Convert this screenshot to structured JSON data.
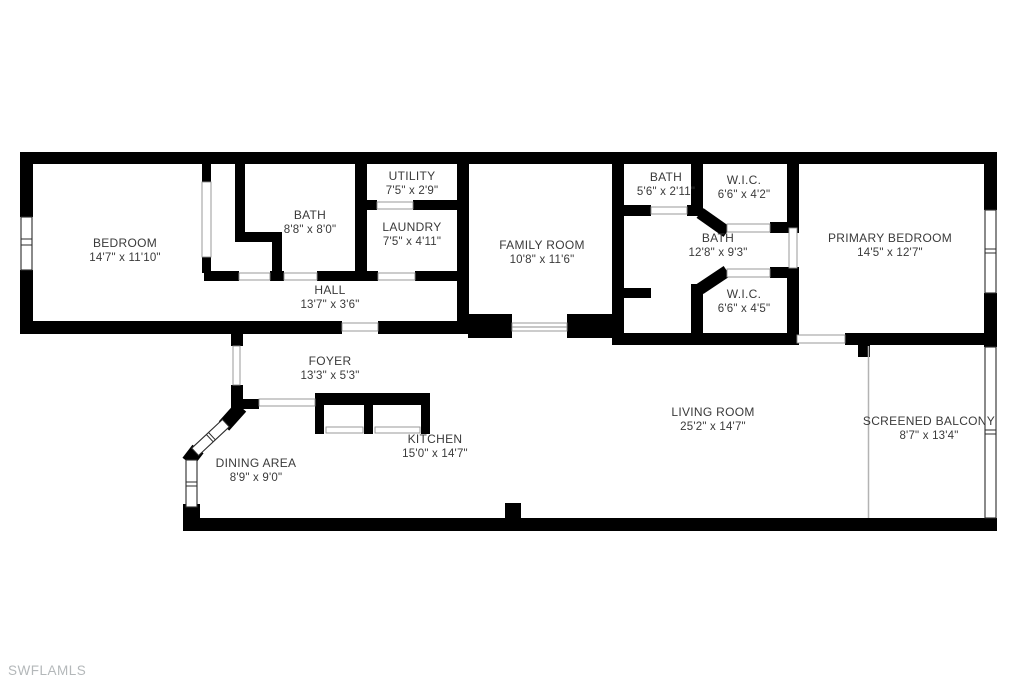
{
  "watermark": "SWFLAMLS",
  "rooms": [
    {
      "name": "BEDROOM",
      "dims": "14'7\" x 11'10\""
    },
    {
      "name": "BATH",
      "dims": "8'8\" x 8'0\""
    },
    {
      "name": "UTILITY",
      "dims": "7'5\" x 2'9\""
    },
    {
      "name": "LAUNDRY",
      "dims": "7'5\" x 4'11\""
    },
    {
      "name": "FAMILY ROOM",
      "dims": "10'8\" x 11'6\""
    },
    {
      "name": "BATH",
      "dims": "5'6\" x 2'11\""
    },
    {
      "name": "W.I.C.",
      "dims": "6'6\" x 4'2\""
    },
    {
      "name": "BATH",
      "dims": "12'8\" x 9'3\""
    },
    {
      "name": "PRIMARY BEDROOM",
      "dims": "14'5\" x 12'7\""
    },
    {
      "name": "W.I.C.",
      "dims": "6'6\" x 4'5\""
    },
    {
      "name": "HALL",
      "dims": "13'7\" x 3'6\""
    },
    {
      "name": "FOYER",
      "dims": "13'3\" x 5'3\""
    },
    {
      "name": "KITCHEN",
      "dims": "15'0\" x 14'7\""
    },
    {
      "name": "DINING AREA",
      "dims": "8'9\" x 9'0\""
    },
    {
      "name": "LIVING ROOM",
      "dims": "25'2\" x 14'7\""
    },
    {
      "name": "SCREENED BALCONY",
      "dims": "8'7\" x 13'4\""
    }
  ],
  "colors": {
    "wall": "#000000",
    "label": "#3a3a3a",
    "watermark": "#b4b8ba",
    "background": "#ffffff"
  }
}
